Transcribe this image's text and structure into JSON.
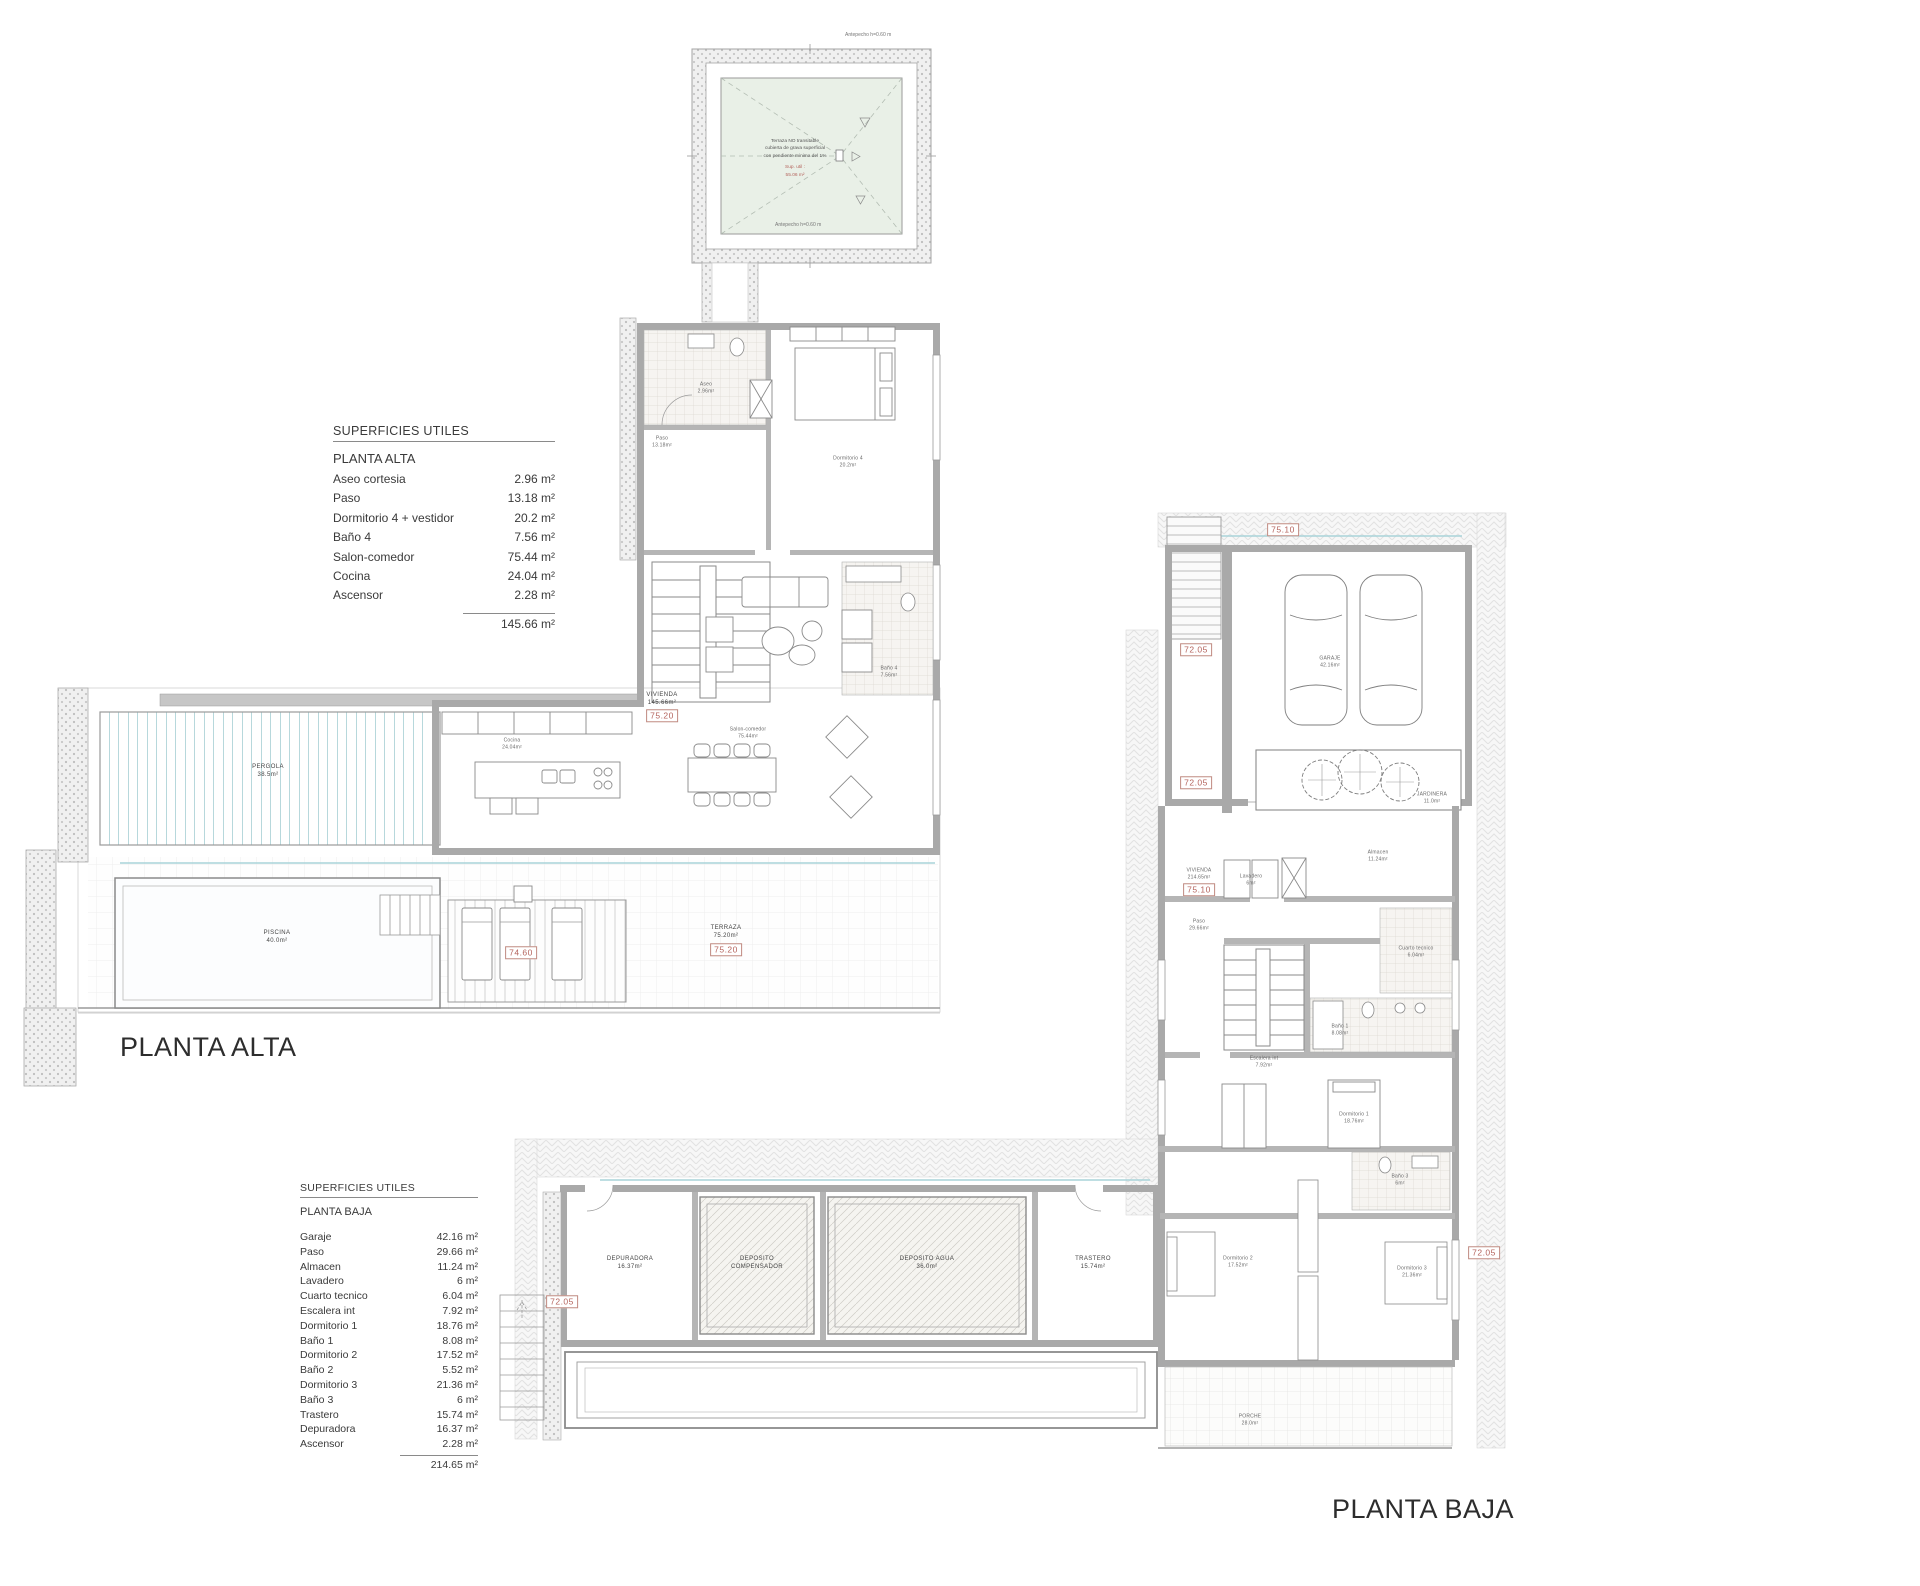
{
  "sheet": {
    "background": "#ffffff"
  },
  "colors": {
    "wall": "#a9a9a9",
    "wall_dark": "#8a8a8a",
    "glass_teal": "#a9d3d9",
    "tag_red": "#b4635c",
    "roof_green": "#e9f0e7",
    "hatch_gray": "#e3e3e3"
  },
  "tables": {
    "alta": {
      "title": "SUPERFICIES UTILES",
      "subtitle": "PLANTA ALTA",
      "rows": [
        {
          "name": "Aseo cortesia",
          "area": "2.96 m²"
        },
        {
          "name": "Paso",
          "area": "13.18 m²"
        },
        {
          "name": "Dormitorio 4 + vestidor",
          "area": "20.2 m²"
        },
        {
          "name": "Baño 4",
          "area": "7.56 m²"
        },
        {
          "name": "Salon-comedor",
          "area": "75.44 m²"
        },
        {
          "name": "Cocina",
          "area": "24.04 m²"
        },
        {
          "name": "Ascensor",
          "area": "2.28 m²"
        }
      ],
      "total": "145.66 m²"
    },
    "baja": {
      "title": "SUPERFICIES UTILES",
      "subtitle": "PLANTA BAJA",
      "rows": [
        {
          "name": "Garaje",
          "area": "42.16 m²"
        },
        {
          "name": "Paso",
          "area": "29.66 m²"
        },
        {
          "name": "Almacen",
          "area": "11.24 m²"
        },
        {
          "name": "Lavadero",
          "area": "6 m²"
        },
        {
          "name": "Cuarto tecnico",
          "area": "6.04 m²"
        },
        {
          "name": "Escalera int",
          "area": "7.92 m²"
        },
        {
          "name": "Dormitorio 1",
          "area": "18.76 m²"
        },
        {
          "name": "Baño 1",
          "area": "8.08 m²"
        },
        {
          "name": "Dormitorio 2",
          "area": "17.52 m²"
        },
        {
          "name": "Baño 2",
          "area": "5.52 m²"
        },
        {
          "name": "Dormitorio 3",
          "area": "21.36 m²"
        },
        {
          "name": "Baño 3",
          "area": "6 m²"
        },
        {
          "name": "Trastero",
          "area": "15.74 m²"
        },
        {
          "name": "Depuradora",
          "area": "16.37 m²"
        },
        {
          "name": "Ascensor",
          "area": "2.28 m²"
        }
      ],
      "total": "214.65 m²"
    }
  },
  "plans": {
    "roof": {
      "note_black": [
        "Terraza NO transitable",
        "cubierta de grava superficial",
        "con pendiente minima del 1%"
      ],
      "note_red": [
        "Sup. util :",
        "55.06 m²"
      ],
      "edge_top": "Antepecho h=0.60 m",
      "edge_bottom": "Antepecho h=0.60 m"
    },
    "alta": {
      "title": "PLANTA ALTA",
      "labels": [
        {
          "t": "PERGOLA\n38.5m²",
          "x": 268,
          "y": 772,
          "c": "room"
        },
        {
          "t": "PISCINA\n40.0m²",
          "x": 277,
          "y": 938,
          "c": "room"
        },
        {
          "t": "TERRAZA\n75.20m²",
          "x": 726,
          "y": 933,
          "c": "room"
        },
        {
          "t": "VIVIENDA\n145.66m²",
          "x": 662,
          "y": 700,
          "c": "room"
        },
        {
          "t": "Paso\n13.18m²",
          "x": 662,
          "y": 442,
          "c": "tiny"
        },
        {
          "t": "Aseo\n2.96m²",
          "x": 706,
          "y": 388,
          "c": "tiny"
        },
        {
          "t": "Dormitorio 4\n20.2m²",
          "x": 848,
          "y": 462,
          "c": "tiny"
        },
        {
          "t": "Baño 4\n7.56m²",
          "x": 889,
          "y": 672,
          "c": "tiny"
        },
        {
          "t": "Cocina\n24.04m²",
          "x": 512,
          "y": 744,
          "c": "tiny"
        },
        {
          "t": "Salon-comedor\n75.44m²",
          "x": 748,
          "y": 733,
          "c": "tiny"
        }
      ],
      "tags": [
        {
          "t": "75.20",
          "x": 662,
          "y": 716
        },
        {
          "t": "75.20",
          "x": 726,
          "y": 950
        },
        {
          "t": "74.60",
          "x": 521,
          "y": 953
        }
      ]
    },
    "baja": {
      "title": "PLANTA BAJA",
      "labels": [
        {
          "t": "GARAJE\n42.16m²",
          "x": 1330,
          "y": 662,
          "c": "tiny"
        },
        {
          "t": "JARDINERA\n11.0m²",
          "x": 1432,
          "y": 798,
          "c": "tiny"
        },
        {
          "t": "VIVIENDA\n214.65m²",
          "x": 1199,
          "y": 874,
          "c": "tiny"
        },
        {
          "t": "Almacen\n11.24m²",
          "x": 1378,
          "y": 856,
          "c": "tiny"
        },
        {
          "t": "Lavadero\n6m²",
          "x": 1251,
          "y": 880,
          "c": "tiny"
        },
        {
          "t": "Paso\n29.66m²",
          "x": 1199,
          "y": 925,
          "c": "tiny"
        },
        {
          "t": "Cuarto tecnico\n6.04m²",
          "x": 1416,
          "y": 952,
          "c": "tiny"
        },
        {
          "t": "Escalera int\n7.92m²",
          "x": 1264,
          "y": 1062,
          "c": "tiny"
        },
        {
          "t": "Baño 1\n8.08m²",
          "x": 1340,
          "y": 1030,
          "c": "tiny"
        },
        {
          "t": "Dormitorio 1\n18.76m²",
          "x": 1354,
          "y": 1118,
          "c": "tiny"
        },
        {
          "t": "Baño 3\n6m²",
          "x": 1400,
          "y": 1180,
          "c": "tiny"
        },
        {
          "t": "Dormitorio 2\n17.52m²",
          "x": 1238,
          "y": 1262,
          "c": "tiny"
        },
        {
          "t": "Dormitorio 3\n21.36m²",
          "x": 1412,
          "y": 1272,
          "c": "tiny"
        },
        {
          "t": "DEPURADORA\n16.37m²",
          "x": 630,
          "y": 1264,
          "c": "room"
        },
        {
          "t": "DEPOSITO\nCOMPENSADOR",
          "x": 757,
          "y": 1264,
          "c": "room"
        },
        {
          "t": "DEPOSITO AGUA\n36.0m²",
          "x": 927,
          "y": 1264,
          "c": "room"
        },
        {
          "t": "TRASTERO\n15.74m²",
          "x": 1093,
          "y": 1264,
          "c": "room"
        },
        {
          "t": "PORCHE\n28.0m²",
          "x": 1250,
          "y": 1420,
          "c": "tiny"
        }
      ],
      "tags": [
        {
          "t": "75.10",
          "x": 1283,
          "y": 530
        },
        {
          "t": "72.05",
          "x": 1196,
          "y": 650
        },
        {
          "t": "72.05",
          "x": 1196,
          "y": 783
        },
        {
          "t": "75.10",
          "x": 1199,
          "y": 890
        },
        {
          "t": "72.05",
          "x": 1484,
          "y": 1253
        },
        {
          "t": "72.05",
          "x": 562,
          "y": 1302
        }
      ]
    }
  }
}
